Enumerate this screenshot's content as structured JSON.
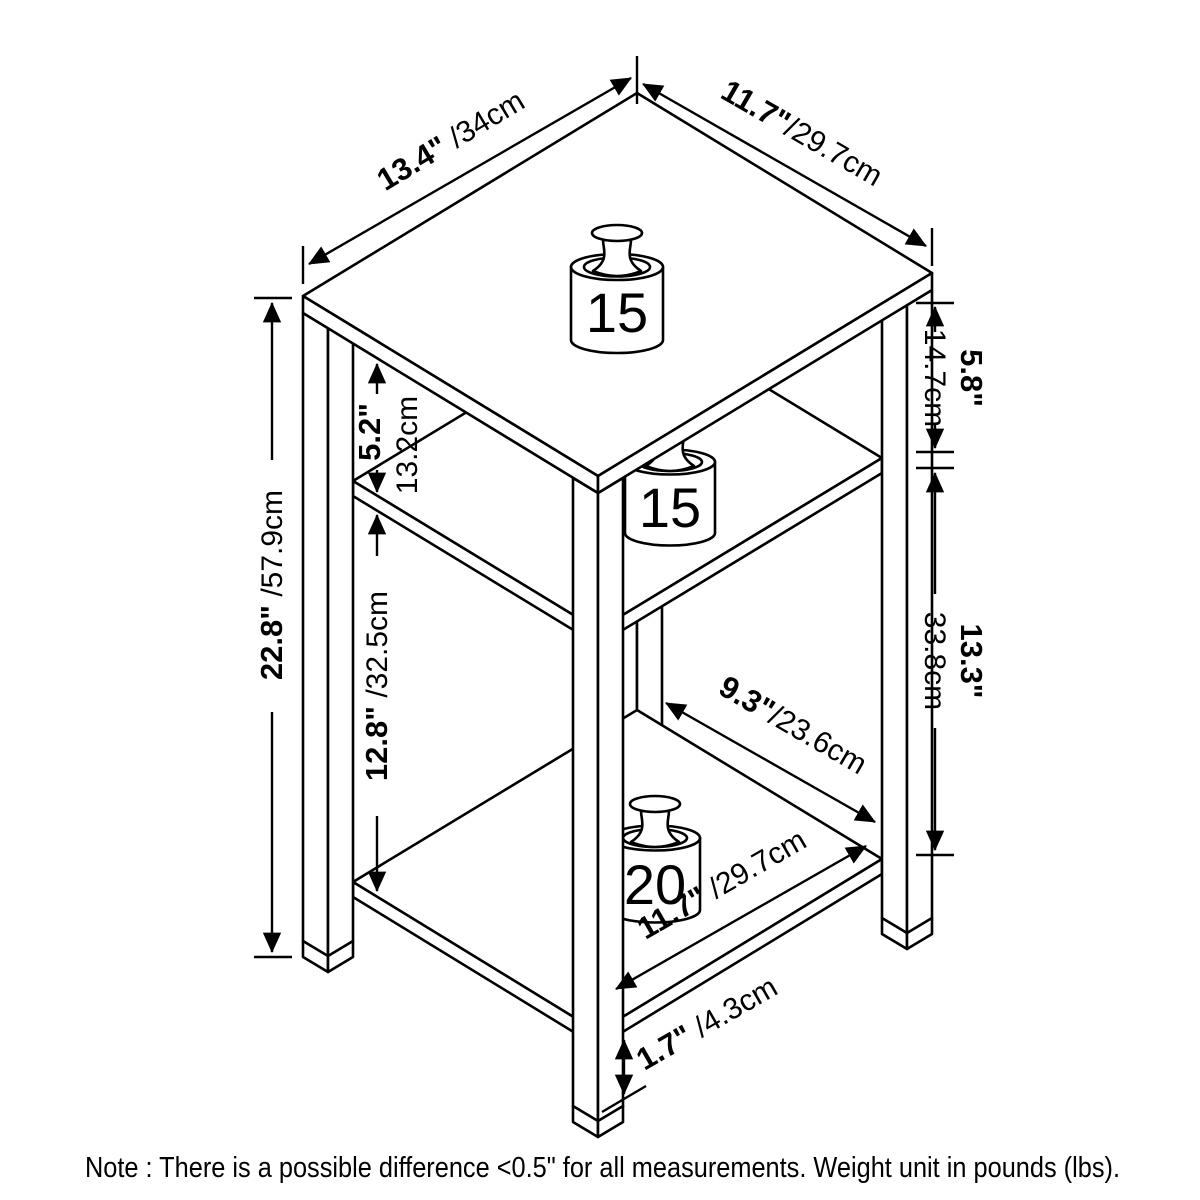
{
  "colors": {
    "line": "#000000",
    "background": "#ffffff"
  },
  "weights": {
    "top": "15",
    "middle": "15",
    "bottom": "20"
  },
  "dims": {
    "top_width": {
      "inch": "13.4\"",
      "cm": " /34cm"
    },
    "top_depth": {
      "inch": "11.7\"",
      "cm": "/29.7cm"
    },
    "right_upper": {
      "inch": "5.8\"",
      "cm": "14.7cm"
    },
    "right_lower": {
      "inch": "13.3\"",
      "cm": "33.8cm"
    },
    "left_height": {
      "inch": "22.8\"",
      "cm": " /57.9cm"
    },
    "inner_upper": {
      "inch": "5.2\"",
      "cm": "13.2cm"
    },
    "inner_lower": {
      "inch": "12.8\"",
      "cm": " /32.5cm"
    },
    "shelf_depth": {
      "inch": "9.3\"",
      "cm": "/23.6cm"
    },
    "bottom_width": {
      "inch": "11.7\"",
      "cm": " /29.7cm"
    },
    "bottom_clearance": {
      "inch": "1.7\"",
      "cm": " /4.3cm"
    }
  },
  "note": "Note : There is a possible difference <0.5\" for all measurements. Weight unit in pounds (lbs)."
}
